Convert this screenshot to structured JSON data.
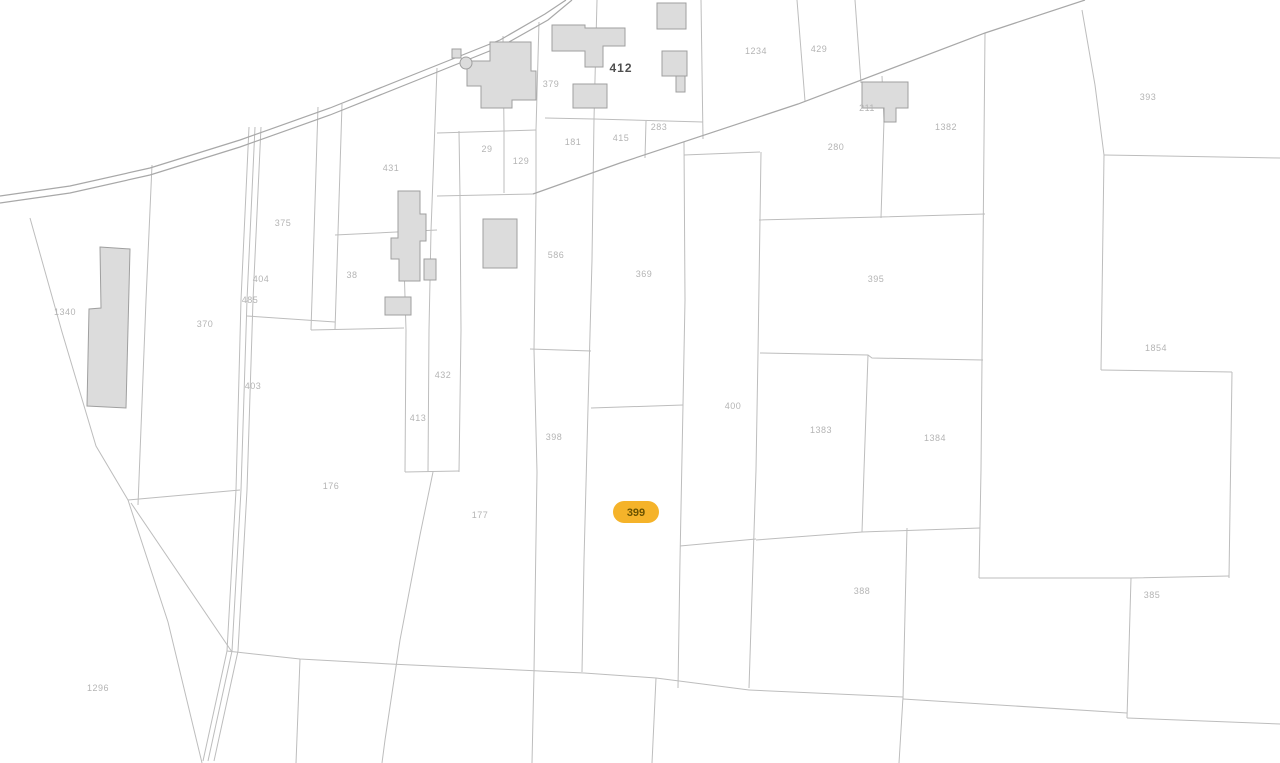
{
  "map": {
    "width": 1280,
    "height": 763,
    "background": "#ffffff",
    "line_color": "#bdbdbd",
    "road_color": "#a8a8a8",
    "building_fill": "#dcdcdc",
    "building_stroke": "#9f9f9f",
    "label_color": "#b4b4b4",
    "label_size": 9,
    "dark_label": {
      "text": "412",
      "x": 621,
      "y": 72,
      "color": "#4f4f4f",
      "size": 12
    },
    "selected_parcel": {
      "label": "399",
      "x": 636,
      "y": 512,
      "pill_fill": "#F5B32A",
      "text_color": "#6b5300"
    },
    "labels": [
      {
        "text": "1340",
        "x": 65,
        "y": 315
      },
      {
        "text": "370",
        "x": 205,
        "y": 327
      },
      {
        "text": "375",
        "x": 283,
        "y": 226
      },
      {
        "text": "404",
        "x": 261,
        "y": 282
      },
      {
        "text": "485",
        "x": 250,
        "y": 303
      },
      {
        "text": "403",
        "x": 253,
        "y": 389
      },
      {
        "text": "431",
        "x": 391,
        "y": 171
      },
      {
        "text": "38",
        "x": 352,
        "y": 278
      },
      {
        "text": "432",
        "x": 443,
        "y": 378
      },
      {
        "text": "413",
        "x": 418,
        "y": 421
      },
      {
        "text": "176",
        "x": 331,
        "y": 489
      },
      {
        "text": "177",
        "x": 480,
        "y": 518
      },
      {
        "text": "29",
        "x": 487,
        "y": 152
      },
      {
        "text": "129",
        "x": 521,
        "y": 164
      },
      {
        "text": "379",
        "x": 551,
        "y": 87
      },
      {
        "text": "181",
        "x": 573,
        "y": 145
      },
      {
        "text": "415",
        "x": 621,
        "y": 141
      },
      {
        "text": "283",
        "x": 659,
        "y": 130
      },
      {
        "text": "1234",
        "x": 756,
        "y": 54
      },
      {
        "text": "429",
        "x": 819,
        "y": 52
      },
      {
        "text": "280",
        "x": 836,
        "y": 150
      },
      {
        "text": "1382",
        "x": 946,
        "y": 130
      },
      {
        "text": "211",
        "x": 867,
        "y": 111
      },
      {
        "text": "586",
        "x": 556,
        "y": 258
      },
      {
        "text": "369",
        "x": 644,
        "y": 277
      },
      {
        "text": "398",
        "x": 554,
        "y": 440
      },
      {
        "text": "400",
        "x": 733,
        "y": 409
      },
      {
        "text": "395",
        "x": 876,
        "y": 282
      },
      {
        "text": "1383",
        "x": 821,
        "y": 433
      },
      {
        "text": "1384",
        "x": 935,
        "y": 441
      },
      {
        "text": "393",
        "x": 1148,
        "y": 100
      },
      {
        "text": "1854",
        "x": 1156,
        "y": 351
      },
      {
        "text": "385",
        "x": 1152,
        "y": 598
      },
      {
        "text": "388",
        "x": 862,
        "y": 594
      },
      {
        "text": "1296",
        "x": 98,
        "y": 691
      }
    ],
    "roads": [
      "0,196 70,186 150,168 240,140 330,108 420,72 500,40 545,14 566,0",
      "0,203 70,193 150,175 240,147 330,115 420,79 502,46 548,20 572,0",
      "533,194 620,163 798,104 985,33 1085,0"
    ],
    "boundaries": [
      "30,218 62,332 96,446 128,500 168,622 202,763",
      "152,165 146,300 138,505",
      "128,500 240,490",
      "131,503 232,652",
      "249,127 241,300 236,490 227,651 203,761",
      "255,127 247,300 241,490 232,651 208,761",
      "261,127 253,300 247,490 238,651 214,761",
      "318,107 311,330",
      "342,104 335,330",
      "247,316 335,322",
      "335,235 437,230",
      "311,330 404,328",
      "403,231 406,330 405,472",
      "437,68 434,150 431,231 429,330 428,472",
      "459,131 460,196 461,330 459,472",
      "405,472 459,471",
      "433,472 420,535 400,640 385,740 382,763",
      "503,36 504,130 504,193",
      "437,133 536,130",
      "437,196 533,194",
      "539,22 536,130 536,193 534,350 537,472 534,672 532,763",
      "545,118 594,119",
      "597,0 594,119",
      "594,119 592,260 588,408 584,560 582,672",
      "594,119 703,122",
      "646,121 645,158",
      "701,0 703,139",
      "797,0 805,101",
      "855,0 861,83",
      "530,349 591,351",
      "591,408 683,405",
      "684,142 685,300 683,405 680,560 678,688",
      "684,155 760,152",
      "761,152 758,353 756,470 749,688",
      "680,546 756,539",
      "882,76 884,120 881,218",
      "759,220 880,217 985,214",
      "985,33 983,250 981,470 979,578",
      "760,353 868,355 872,358 983,360",
      "868,355 864,470 862,532",
      "756,540 862,532 980,528",
      "907,528 903,699",
      "749,690 903,697",
      "903,697 899,763",
      "903,699 1127,713",
      "1104,155 1101,370",
      "1101,370 1232,372",
      "1232,372 1229,578",
      "979,578 1130,578 1229,576",
      "1131,578 1127,718",
      "1127,718 1280,724",
      "1104,155 1280,158",
      "1082,10 1095,85 1104,155",
      "300,659 296,763",
      "656,678 652,763",
      "227,651 300,659 390,664 540,671 584,673 656,678 749,690"
    ],
    "buildings": [
      "552,25 585,25 585,28 625,28 625,46 603,46 603,67 585,67 585,51 552,51",
      "573,84 607,84 607,108 573,108",
      "490,42 531,42 531,71 536,71 536,100 512,100 512,108 481,108 481,86 467,86 467,61 490,61",
      "452,49 461,49 461,58 452,58",
      "657,3 686,3 686,29 657,29",
      "662,51 687,51 687,76 662,76",
      "676,76 685,76 685,92 676,92",
      "862,82 908,82 908,108 896,108 896,122 884,122 884,108 862,108",
      "100,247 130,249 126,408 87,406 89,309 101,308",
      "398,191 420,191 420,214 426,214 426,241 420,241 420,281 399,281 399,259 391,259 391,238 398,238",
      "424,259 436,259 436,280 424,280",
      "385,297 411,297 411,315 385,315",
      "483,219 517,219 517,268 483,268"
    ],
    "tank_circle": {
      "cx": 466,
      "cy": 63,
      "r": 6
    }
  }
}
